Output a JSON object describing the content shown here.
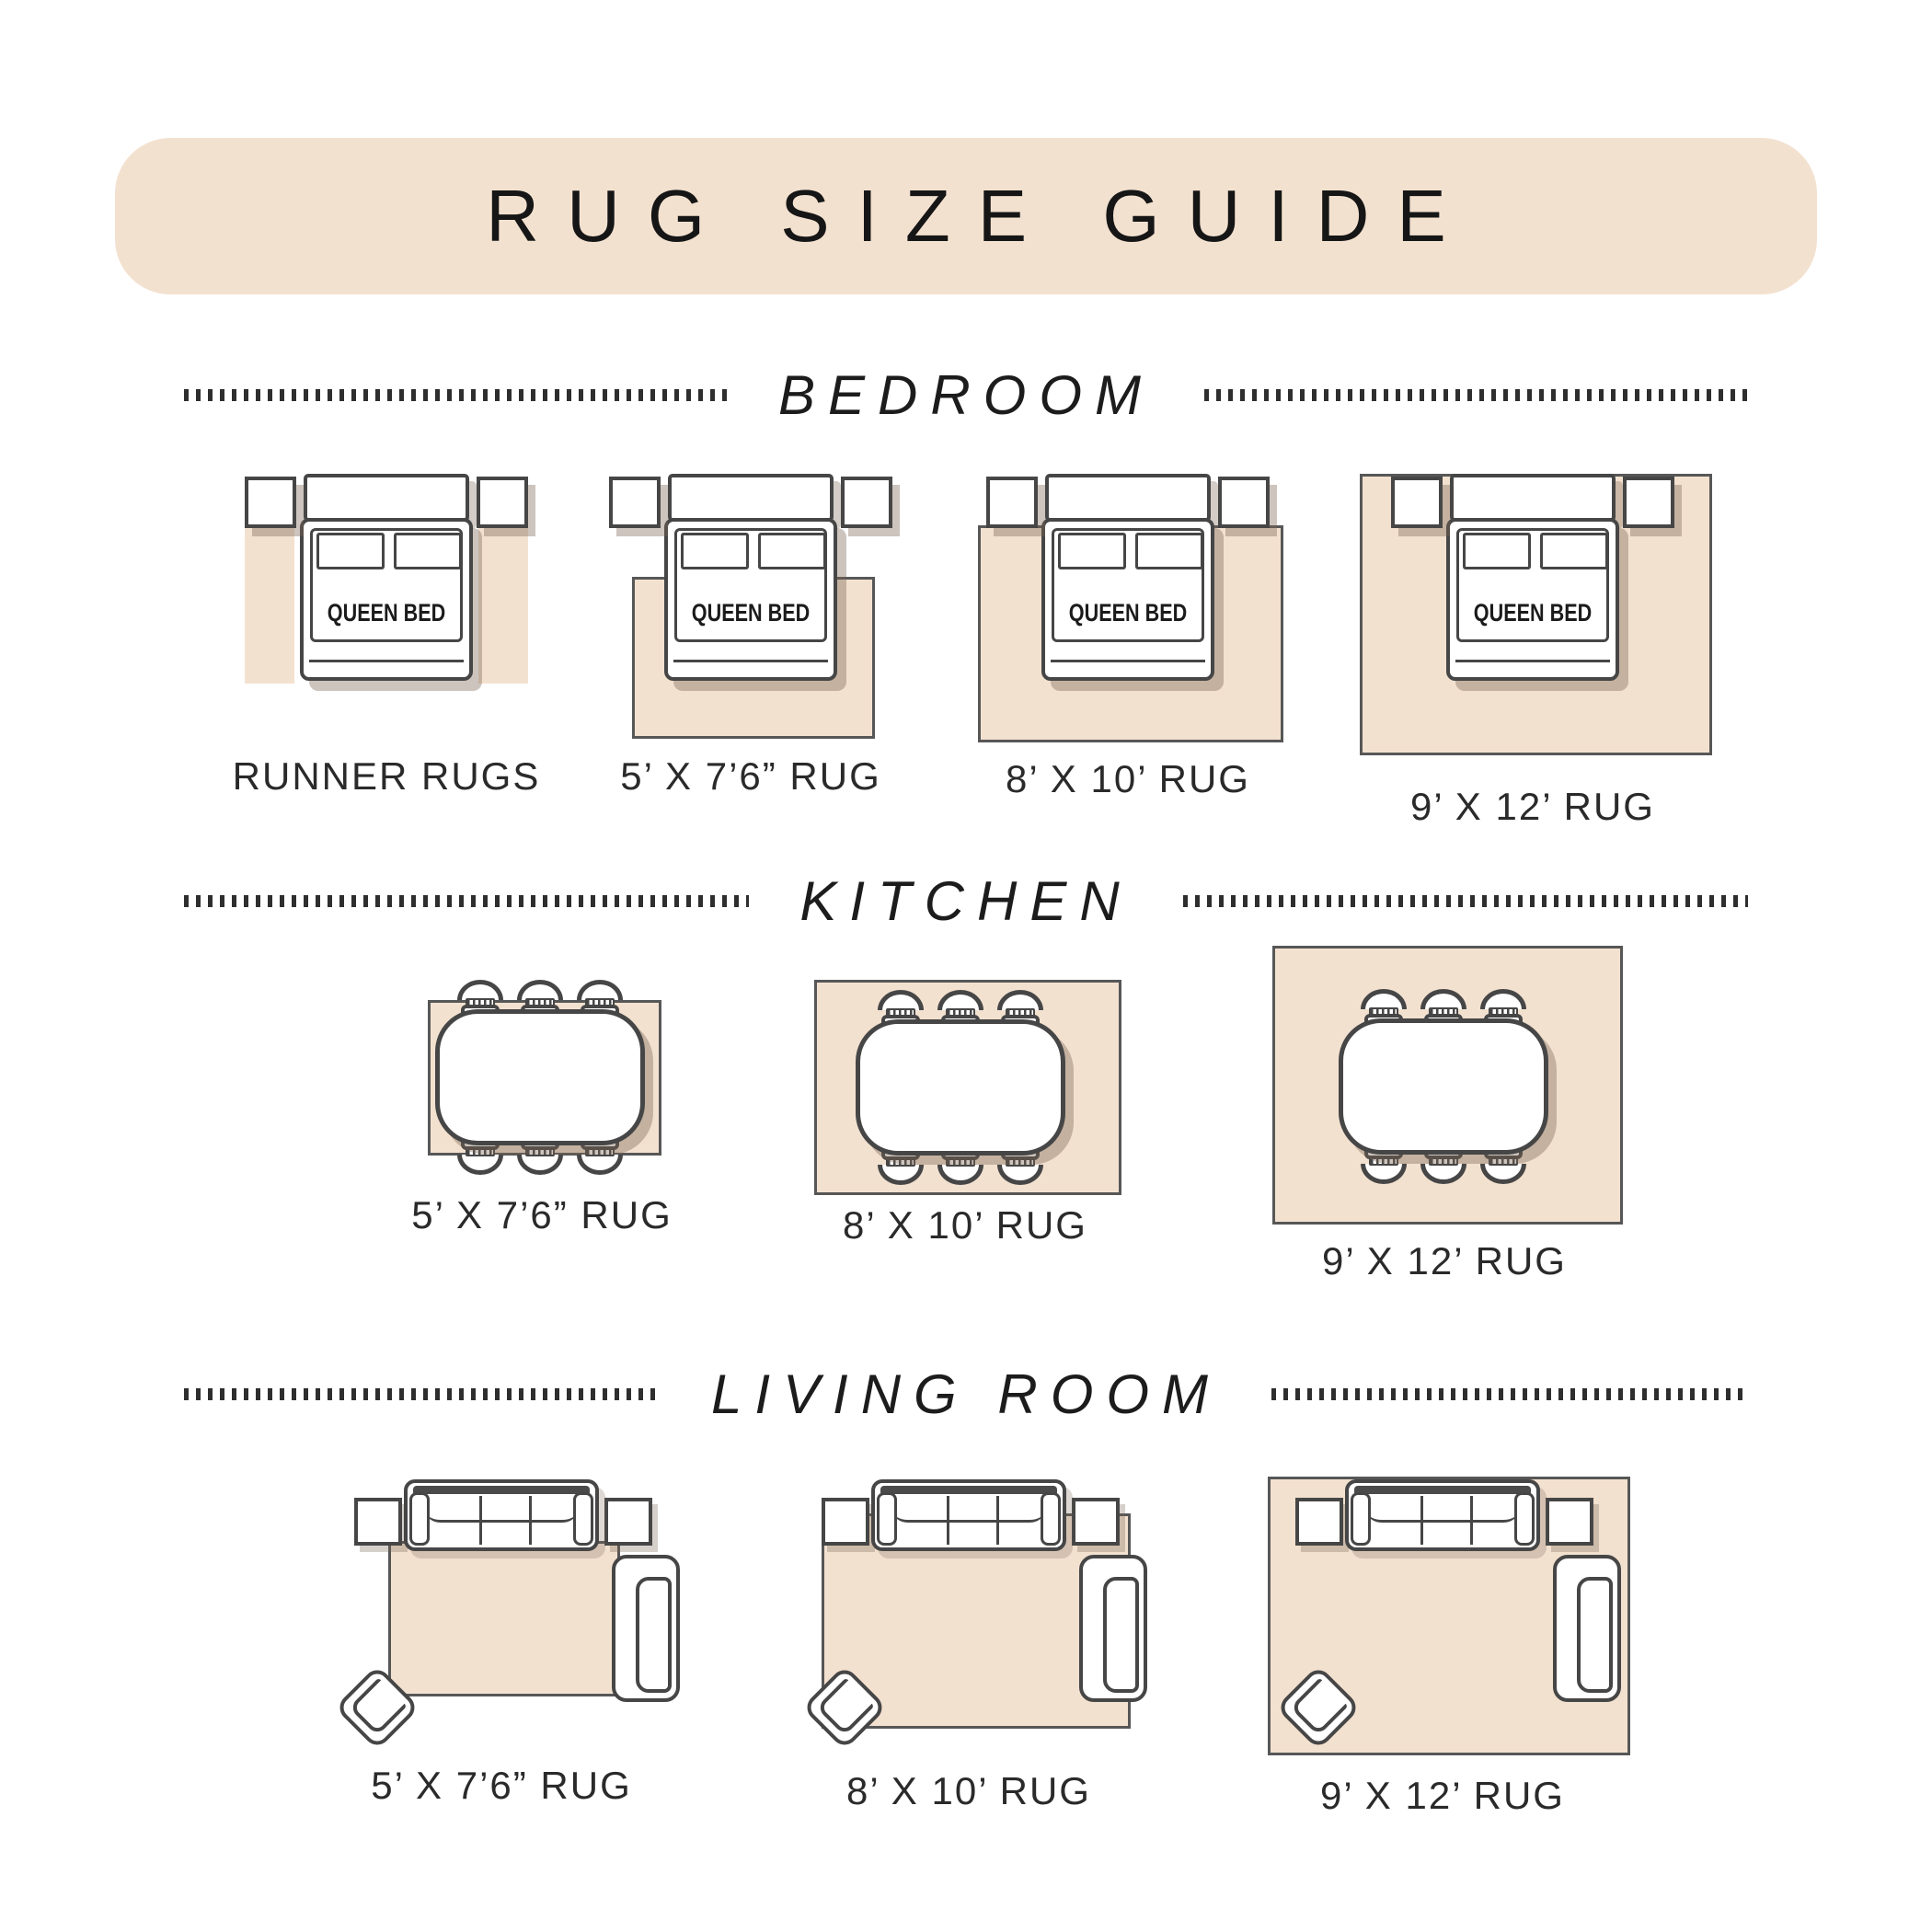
{
  "title": "RUG SIZE GUIDE",
  "bed_label": "QUEEN BED",
  "colors": {
    "banner_bg": "#f3e1d0",
    "rug_fill": "#f3e1d0",
    "furniture_outline": "#464646",
    "text": "#262626"
  },
  "sections": [
    {
      "name": "BEDROOM",
      "items": [
        {
          "label": "RUNNER RUGS"
        },
        {
          "label": "5’ X 7’6” RUG"
        },
        {
          "label": "8’ X 10’ RUG"
        },
        {
          "label": "9’ X 12’ RUG"
        }
      ]
    },
    {
      "name": "KITCHEN",
      "items": [
        {
          "label": "5’ X 7’6” RUG"
        },
        {
          "label": "8’ X 10’ RUG"
        },
        {
          "label": "9’ X 12’ RUG"
        }
      ]
    },
    {
      "name": "LIVING ROOM",
      "items": [
        {
          "label": "5’ X 7’6” RUG"
        },
        {
          "label": "8’ X 10’ RUG"
        },
        {
          "label": "9’ X 12’ RUG"
        }
      ]
    }
  ]
}
